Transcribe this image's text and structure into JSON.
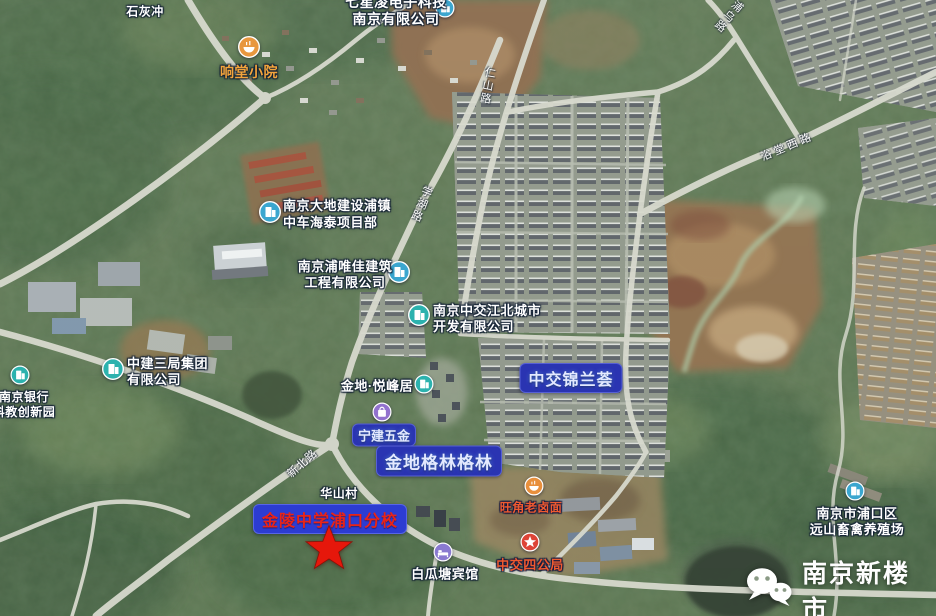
{
  "labels": {
    "shihuichong": "石灰冲",
    "xiangtang": "响堂小院",
    "qixing_l1": "七星凌电子科技",
    "qixing_l2": "南京有限公司",
    "dadi_l1": "南京大地建设浦镇",
    "dadi_l2": "中车海泰项目部",
    "puweijia_l1": "南京浦唯佳建筑",
    "puweijia_l2": "工程有限公司",
    "zhongjian_l1": "中建三局集团",
    "zhongjian_l2": "有限公司",
    "njbank_l1": "南京银行",
    "njbank_l2": "科教创新园",
    "yuefeng": "金地·悦峰居",
    "zjdev_l1": "南京中交江北城市",
    "zjdev_l2": "开发有限公司",
    "jinlanhui": "中交锦兰荟",
    "ningjian": "宁建五金",
    "gelin": "金地格林格林",
    "huashan": "华山村",
    "wangjiao": "旺角老卤面",
    "jinling": "金陵中学浦口分校",
    "baiguatang": "白瓜塘宾馆",
    "sigongju": "中交四公局",
    "yuanshan_l1": "南京市浦口区",
    "yuanshan_l2": "远山畜禽养殖场"
  },
  "roads": {
    "xuehu": "学湖路",
    "renshan": "仁山路",
    "puwu": "浦乌路",
    "yutang": "浴堂西路",
    "xinbei": "新北路"
  },
  "watermark": {
    "text": "南京新楼市",
    "icon": "wechat-icon"
  },
  "marker": {
    "type": "red-star",
    "color": "#e6170b"
  },
  "colors": {
    "highlight_box": "#2a34b2",
    "school_box": "#2c3cd2",
    "school_text": "#ea2417",
    "star_red": "#e6170b",
    "poi_blue": "#3ba6cf",
    "poi_teal": "#2cb2ae",
    "poi_purple": "#9272ce",
    "poi_orange": "#e89440",
    "poi_red": "#dd4437",
    "label_orange": "#f2a43c",
    "label_redorange": "#ef5a30"
  }
}
